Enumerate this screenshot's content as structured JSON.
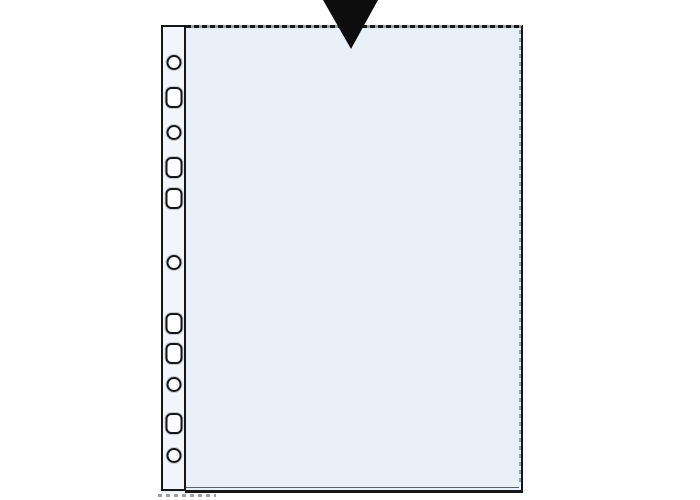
{
  "illustration": {
    "subject": "punched-transparent-pocket",
    "arrow": {
      "icon": "arrow-down-icon",
      "direction": "down"
    },
    "edges": {
      "top": "dashed-open-edge",
      "right": "solid-edge-with-dotted-seam",
      "bottom": "solid-welded-edge-with-inner-seam",
      "left": "multi-punched-filing-strip"
    },
    "colors": {
      "background": "#ffffff",
      "outline": "#17171a",
      "body_fill": "#e9f0f8",
      "strip_fill": "#f2f6fa",
      "seam_gray": "#98a0a8",
      "arrow": "#0d0d0d"
    },
    "punch_holes": [
      {
        "type": "round",
        "y": 62
      },
      {
        "type": "oval",
        "y": 97
      },
      {
        "type": "round",
        "y": 132
      },
      {
        "type": "oval",
        "y": 167
      },
      {
        "type": "oval",
        "y": 198
      },
      {
        "type": "round",
        "y": 262
      },
      {
        "type": "oval",
        "y": 323
      },
      {
        "type": "oval",
        "y": 353
      },
      {
        "type": "round",
        "y": 384
      },
      {
        "type": "oval",
        "y": 423
      },
      {
        "type": "round",
        "y": 455
      }
    ]
  }
}
